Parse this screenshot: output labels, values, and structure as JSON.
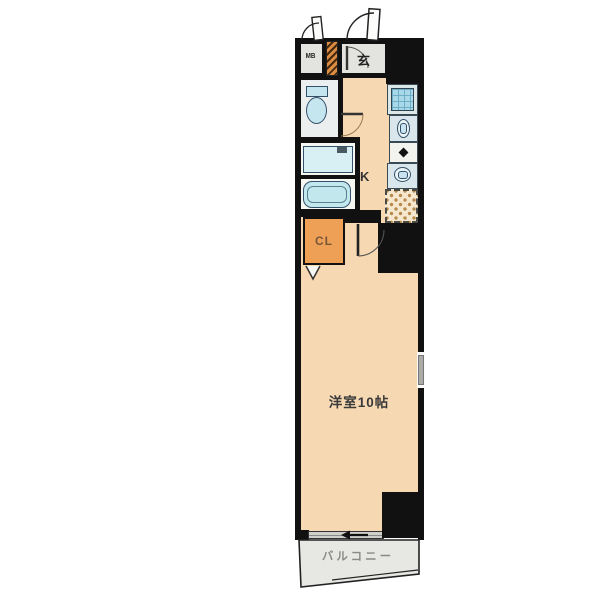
{
  "meta": {
    "title": "apartment floor plan",
    "plan_type": "1K mansion madori"
  },
  "labels": {
    "meter_box": "MB",
    "entrance": "玄",
    "kitchen": "K",
    "closet": "CL",
    "main_room": "洋室10帖",
    "balcony": "バルコニー"
  },
  "colors": {
    "wall": "#111111",
    "room_floor": "#F6D8B2",
    "gray_floor": "#E3E3DF",
    "fixture_blue": "#C5E6EF",
    "kitchen_sink_blue": "#A9D8E8",
    "closet_orange": "#EFA057",
    "hatch_orange": "#D98C42",
    "tile_dot_tan": "#B98A4E",
    "balcony_gray": "#E7E7E3"
  },
  "fixtures": {
    "icons": [
      "entrance-door",
      "meter-box-door",
      "toilet",
      "washbasin-vanity",
      "bathtub",
      "kitchen-sink",
      "sink-bowl",
      "stove-burner",
      "sink-bowl-2",
      "tile-pad",
      "closet-fold-arrow",
      "sliding-window",
      "small-window",
      "balcony-rail"
    ]
  }
}
